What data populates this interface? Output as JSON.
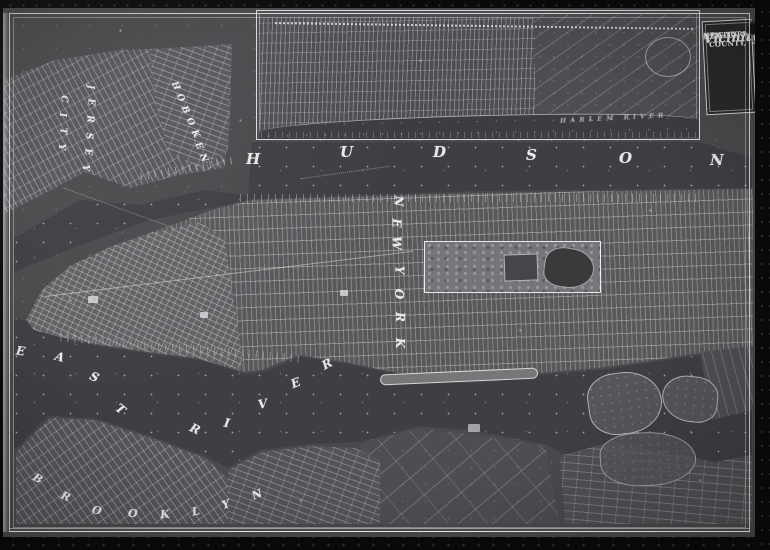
{
  "title_block": {
    "line1": "NEW-YORK",
    "line2": "CITY COUNTY,",
    "line3": "AND",
    "line4": "Vicinity"
  },
  "labels": [
    {
      "id": "hudson-river",
      "text": "HUDSON",
      "size": 15,
      "letters": [
        [
          "H",
          246,
          150
        ],
        [
          "U",
          340,
          143
        ],
        [
          "D",
          433,
          143
        ],
        [
          "S",
          526,
          146
        ],
        [
          "O",
          619,
          149
        ],
        [
          "N",
          710,
          151
        ]
      ]
    },
    {
      "id": "new-york",
      "text": "NEW YORK",
      "size": 12,
      "letters": [
        [
          "N",
          393,
          194,
          90
        ],
        [
          "E",
          392,
          216,
          90
        ],
        [
          "W",
          390,
          236,
          90
        ],
        [
          "Y",
          395,
          263,
          90
        ],
        [
          "O",
          394,
          287,
          90
        ],
        [
          "R",
          395,
          310,
          90
        ],
        [
          "K",
          395,
          336,
          90
        ]
      ]
    },
    {
      "id": "east",
      "text": "EAST",
      "size": 12,
      "letters": [
        [
          "E",
          16,
          344,
          8
        ],
        [
          "A",
          55,
          350,
          15
        ],
        [
          "S",
          90,
          370,
          25
        ],
        [
          "T",
          116,
          402,
          40
        ]
      ]
    },
    {
      "id": "river",
      "text": "RIVER",
      "size": 12,
      "letters": [
        [
          "R",
          190,
          422,
          25
        ],
        [
          "I",
          224,
          416,
          10
        ],
        [
          "V",
          258,
          397,
          -10
        ],
        [
          "E",
          291,
          376,
          -22
        ],
        [
          "R",
          322,
          357,
          -28
        ]
      ]
    },
    {
      "id": "brooklyn",
      "text": "BROOKLYN",
      "size": 11,
      "letters": [
        [
          "B",
          33,
          472,
          30
        ],
        [
          "R",
          61,
          490,
          25
        ],
        [
          "O",
          92,
          504,
          15
        ],
        [
          "O",
          128,
          507,
          5
        ],
        [
          "K",
          160,
          508,
          -5
        ],
        [
          "L",
          192,
          505,
          -12
        ],
        [
          "Y",
          222,
          498,
          -18
        ],
        [
          "N",
          252,
          488,
          -24
        ]
      ]
    },
    {
      "id": "jersey",
      "text": "JERSEY",
      "size": 9,
      "letters": [
        [
          "J",
          88,
          82,
          90
        ],
        [
          "E",
          87,
          97,
          90
        ],
        [
          "R",
          86,
          114,
          90
        ],
        [
          "S",
          85,
          131,
          90
        ],
        [
          "E",
          84,
          147,
          90
        ],
        [
          "Y",
          82,
          163,
          90
        ]
      ]
    },
    {
      "id": "city",
      "text": "CITY",
      "size": 9,
      "letters": [
        [
          "C",
          60,
          94,
          90
        ],
        [
          "I",
          60,
          110,
          90
        ],
        [
          "T",
          59,
          126,
          90
        ],
        [
          "Y",
          58,
          142,
          90
        ]
      ]
    },
    {
      "id": "hoboken",
      "text": "HOBOKEN",
      "size": 9,
      "letters": [
        [
          "H",
          171,
          81,
          65
        ],
        [
          "O",
          176,
          93,
          65
        ],
        [
          "B",
          181,
          105,
          65
        ],
        [
          "O",
          186,
          117,
          65
        ],
        [
          "K",
          191,
          129,
          65
        ],
        [
          "E",
          195,
          141,
          65
        ],
        [
          "N",
          199,
          153,
          65
        ]
      ]
    },
    {
      "id": "harlem-river",
      "text": "HARLEM RIVER",
      "size": 6.5,
      "x": 560,
      "y": 114,
      "rot": -3,
      "spacing": 4,
      "opacity": 0.6
    }
  ],
  "colors": {
    "surround_black": "#0b0b0c",
    "sheet_gray": "#4a4a4d",
    "water_gray": "#3f3f43",
    "grid_gray": "#59595c",
    "park_gray": "#76767a",
    "line_white": "#eeeef0",
    "cartouche_bg": "#29292c"
  }
}
